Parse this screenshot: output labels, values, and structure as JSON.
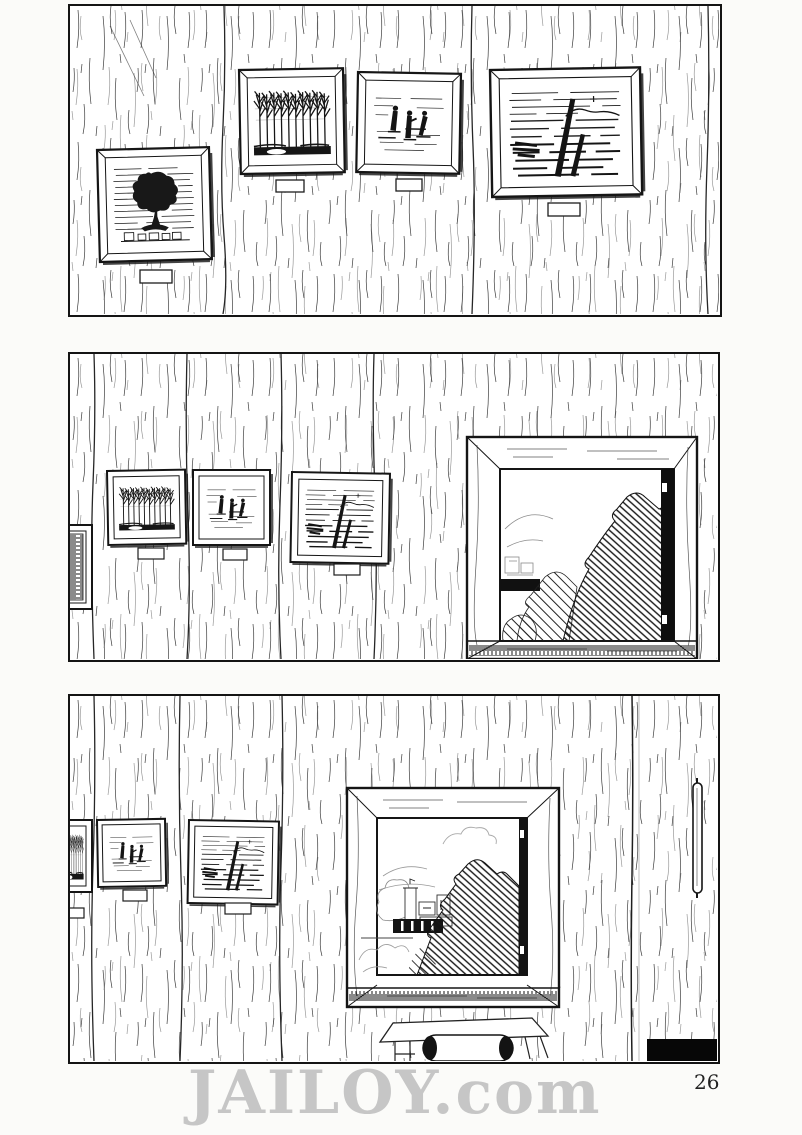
{
  "page": {
    "watermark": "JAILOY.com",
    "page_number": "26"
  },
  "colors": {
    "paper": "#fbfbf9",
    "ink": "#1a1a1a",
    "watermark_gray": "#c6c6c6",
    "black_fill": "#101010"
  },
  "panels": [
    {
      "id": "panel-1",
      "scene": "wood plank wall with four framed pictures, each with a blank placard below",
      "artworks": [
        "lone tree over village",
        "bare forest",
        "standing figures",
        "sinking ship masts at sea"
      ]
    },
    {
      "id": "panel-2",
      "scene": "same wall farther along: edge-on picture, forest picture, figures picture, shipwreck picture, and an open window",
      "window_view": "dense trees and foliage close outside, open dark casement at right"
    },
    {
      "id": "panel-3",
      "scene": "wall end with partial forest picture, figures picture, shipwreck picture, large window, bench with paper roll, door with handle, black corner box",
      "window_view": "distant village, tower, mountains and clouds with dark foliage at right"
    }
  ]
}
